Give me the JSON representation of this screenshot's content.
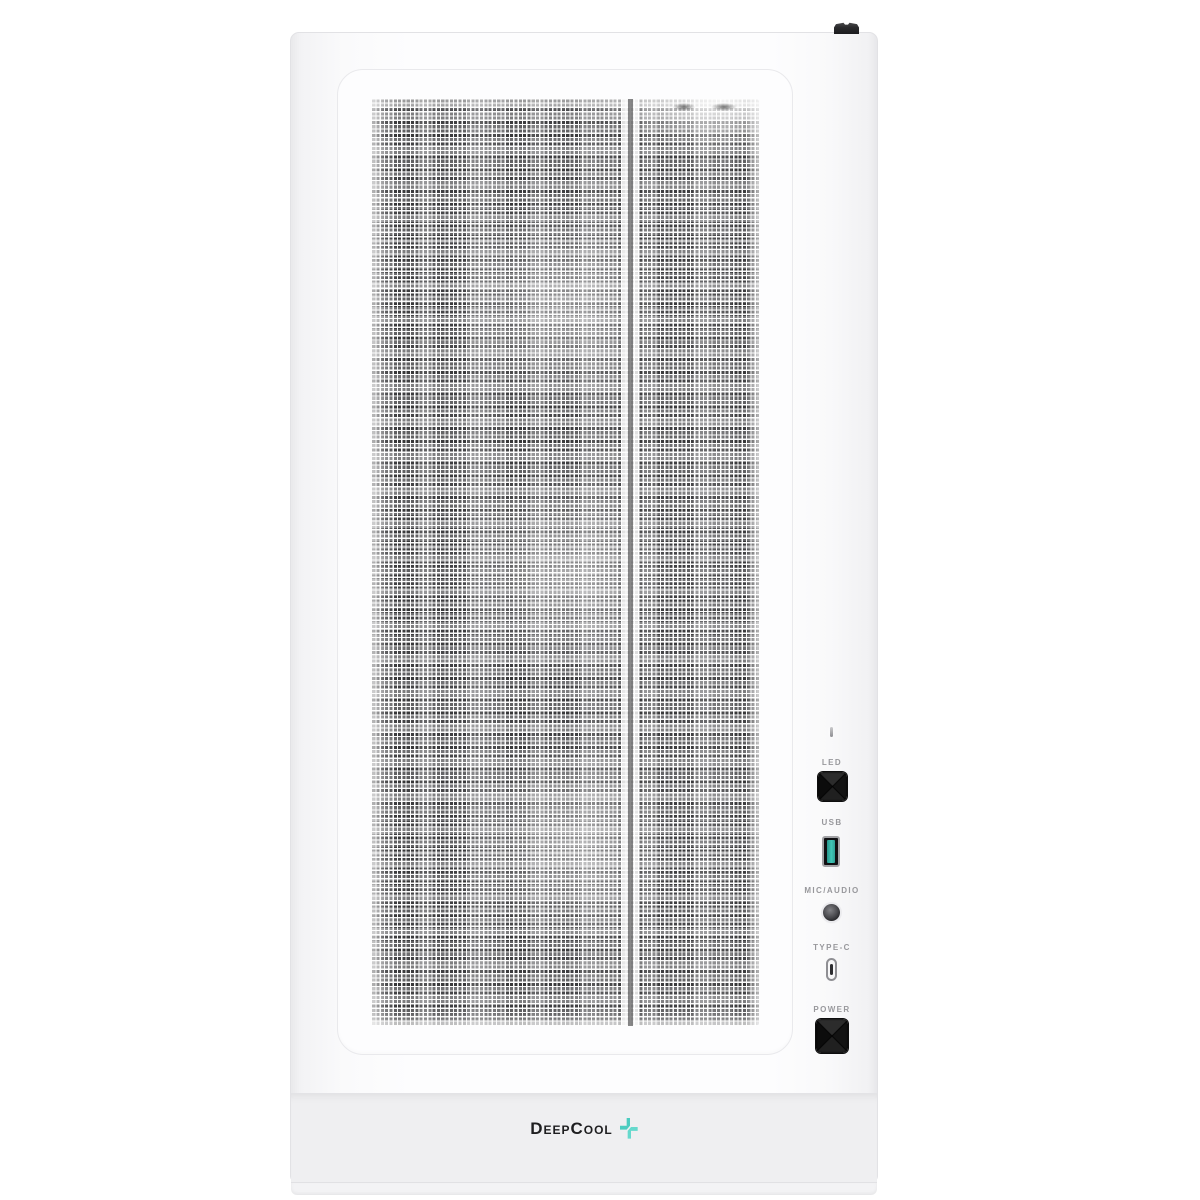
{
  "io_panel": {
    "indicator_icon": "hdd-activity-led",
    "items": [
      {
        "label": "LED",
        "control": "led-mode-button"
      },
      {
        "label": "USB",
        "control": "usb-a-port"
      },
      {
        "label": "MIC/AUDIO",
        "control": "audio-combo-jack"
      },
      {
        "label": "TYPE-C",
        "control": "usb-type-c-port"
      },
      {
        "label": "POWER",
        "control": "power-button"
      }
    ]
  },
  "branding": {
    "logo_text": "DeepCool",
    "logo_mark_icon": "plus-icon"
  },
  "colors": {
    "background": "#ffffff",
    "case_body": "#fbfbfd",
    "mesh_dark": "#525255",
    "bottom_bezel": "#efeff1",
    "io_button_black": "#141414",
    "usb_tongue_teal": "#38b8aa",
    "type_c_slot": "#2d2d30",
    "logo_teal_dark": "#4cccc0",
    "logo_teal_light": "#66d9cd",
    "label_gray": "#98989c",
    "logo_text_color": "#1e1e20"
  }
}
